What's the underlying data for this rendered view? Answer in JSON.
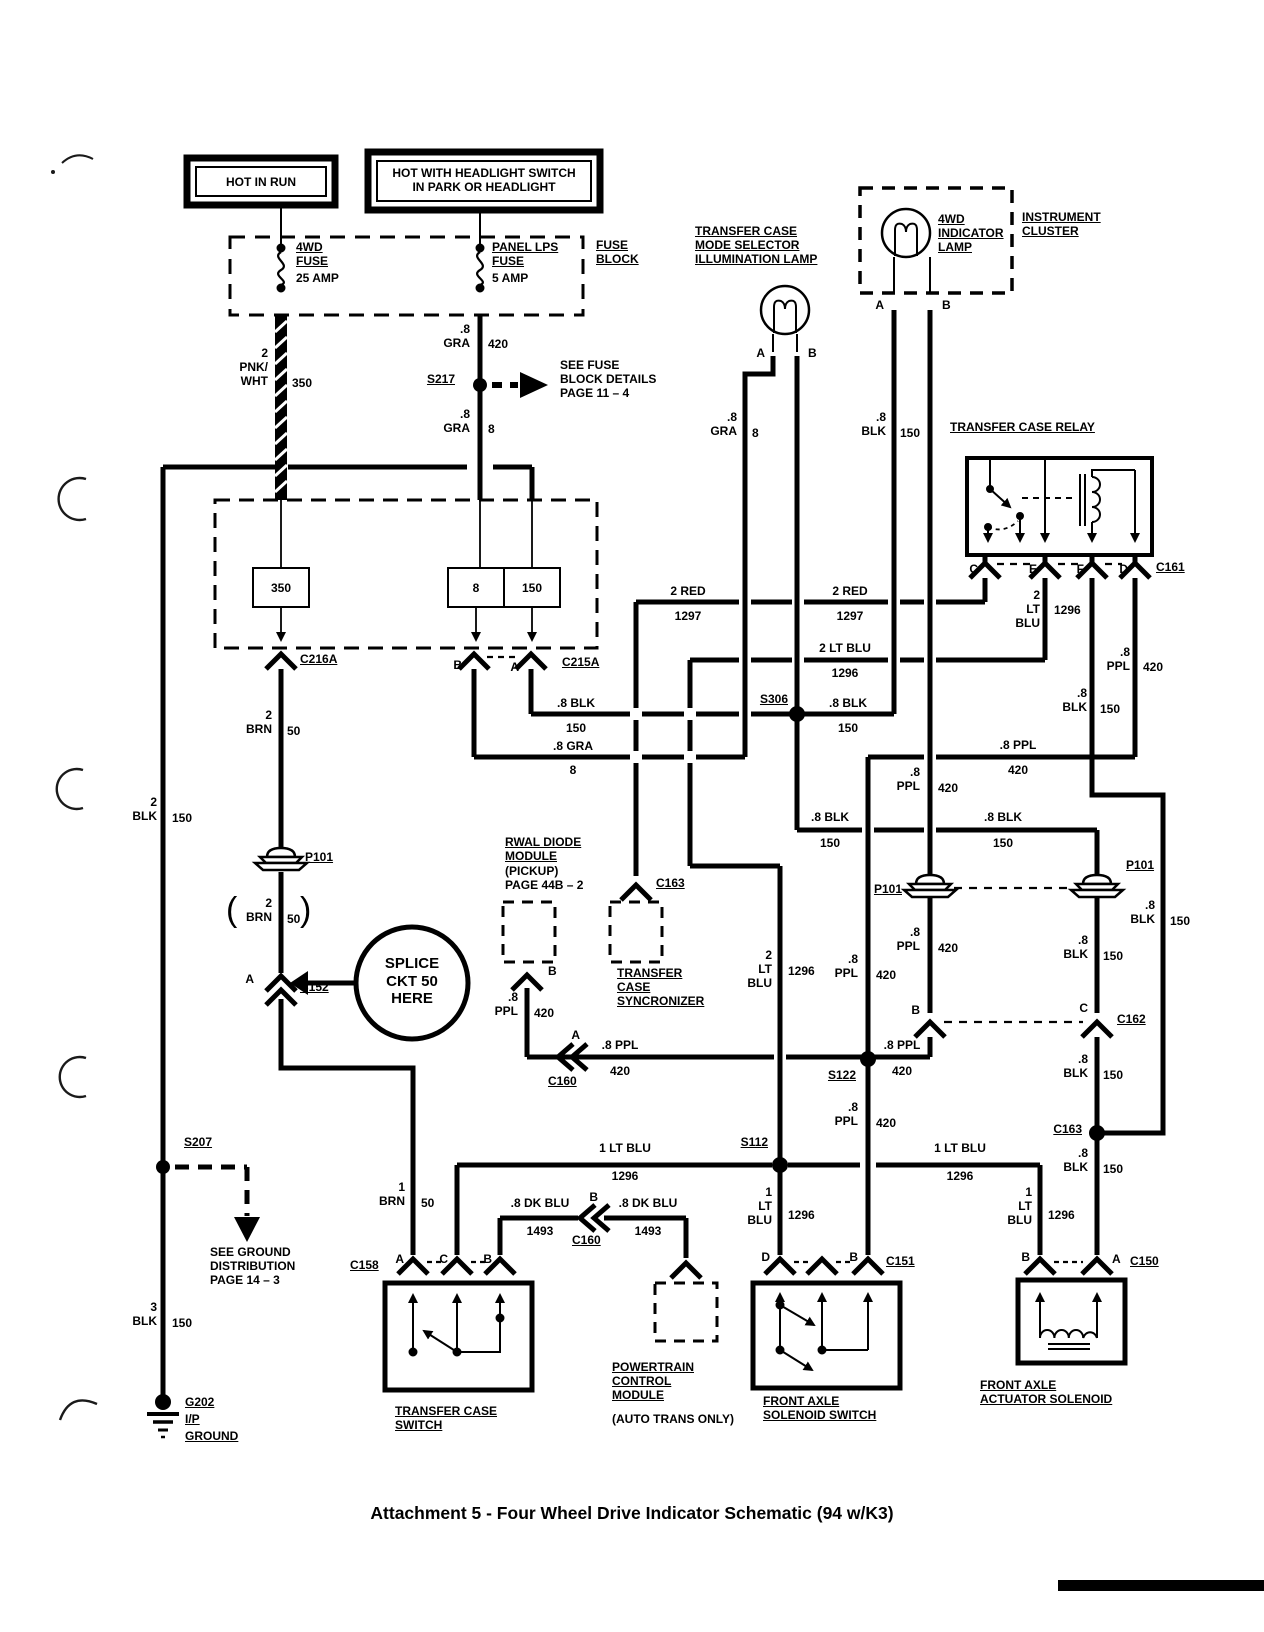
{
  "colors": {
    "ink": "#000000",
    "paper": "#ffffff"
  },
  "caption": "Attachment 5 - Four Wheel Drive Indicator Schematic (94 w/K3)",
  "power": {
    "hot_in_run": "HOT IN RUN",
    "hot_headlight": "HOT WITH HEADLIGHT SWITCH\nIN PARK OR HEADLIGHT"
  },
  "fuse_block": {
    "title": "FUSE\nBLOCK",
    "fuse_4wd_name": "4WD\nFUSE",
    "fuse_4wd_amp": "25 AMP",
    "fuse_panel_name": "PANEL LPS\nFUSE",
    "fuse_panel_amp": "5 AMP"
  },
  "components": {
    "mode_lamp": "TRANSFER CASE\nMODE SELECTOR\nILLUMINATION LAMP",
    "ind_lamp": "4WD\nINDICATOR\nLAMP",
    "cluster": "INSTRUMENT\nCLUSTER",
    "relay": "TRANSFER CASE RELAY",
    "rwal": "RWAL DIODE\nMODULE",
    "rwal_note": "(PICKUP)\nPAGE 44B – 2",
    "sync": "TRANSFER\nCASE\nSYNCRONIZER",
    "tc_switch": "TRANSFER CASE\nSWITCH",
    "pcm": "POWERTRAIN\nCONTROL\nMODULE",
    "pcm_note": "(AUTO TRANS ONLY)",
    "fa_switch": "FRONT AXLE\nSOLENOID SWITCH",
    "fa_solenoid": "FRONT AXLE\nACTUATOR SOLENOID",
    "ip": "I/P",
    "ground": "GROUND"
  },
  "notes": {
    "see_fuse": "SEE FUSE\nBLOCK DETAILS\nPAGE 11 – 4",
    "see_ground": "SEE GROUND\nDISTRIBUTION\nPAGE 14 – 3",
    "splice": "SPLICE\nCKT 50\nHERE",
    "paren_l": "(",
    "paren_r": ")"
  },
  "connectors": {
    "c161": "C161",
    "c162": "C162",
    "c163": "C163",
    "c152": "C152",
    "c158": "C158",
    "c151": "C151",
    "c150": "C150",
    "c160": "C160",
    "c215a": "C215A",
    "c216a": "C216A",
    "p101": "P101",
    "s207": "S207",
    "s217": "S217",
    "s306": "S306",
    "s112": "S112",
    "s122": "S122",
    "g202": "G202"
  },
  "pins": {
    "a": "A",
    "b": "B",
    "c": "C",
    "d": "D",
    "e": "E",
    "f": "F"
  },
  "resistors": {
    "r350": "350",
    "r8": "8",
    "r150": "150"
  },
  "wires": {
    "g2_pnkwht": "2\nPNK/\nWHT",
    "c350": "350",
    "g8_gra": ".8\nGRA",
    "c420": "420",
    "c8": "8",
    "g8_blk": ".8\nBLK",
    "c150": "150",
    "g8_ppl": ".8\nPPL",
    "g2_ltblu": "2\nLT\nBLU",
    "c1296": "1296",
    "g1_ltblu": "1\nLT\nBLU",
    "g2_brn": "2\nBRN",
    "c50": "50",
    "g1_brn": "1\nBRN",
    "g2_blk": "2\nBLK",
    "g3_blk": "3\nBLK",
    "h_2red": "2 RED",
    "c1297": "1297",
    "h_2ltblu": "2 LT BLU",
    "h_8blk": ".8 BLK",
    "h_8gra": ".8 GRA",
    "h_8ppl": ".8 PPL",
    "h_1ltblu": "1 LT BLU",
    "h_8dkblu": ".8 DK BLU",
    "c1493": "1493"
  }
}
